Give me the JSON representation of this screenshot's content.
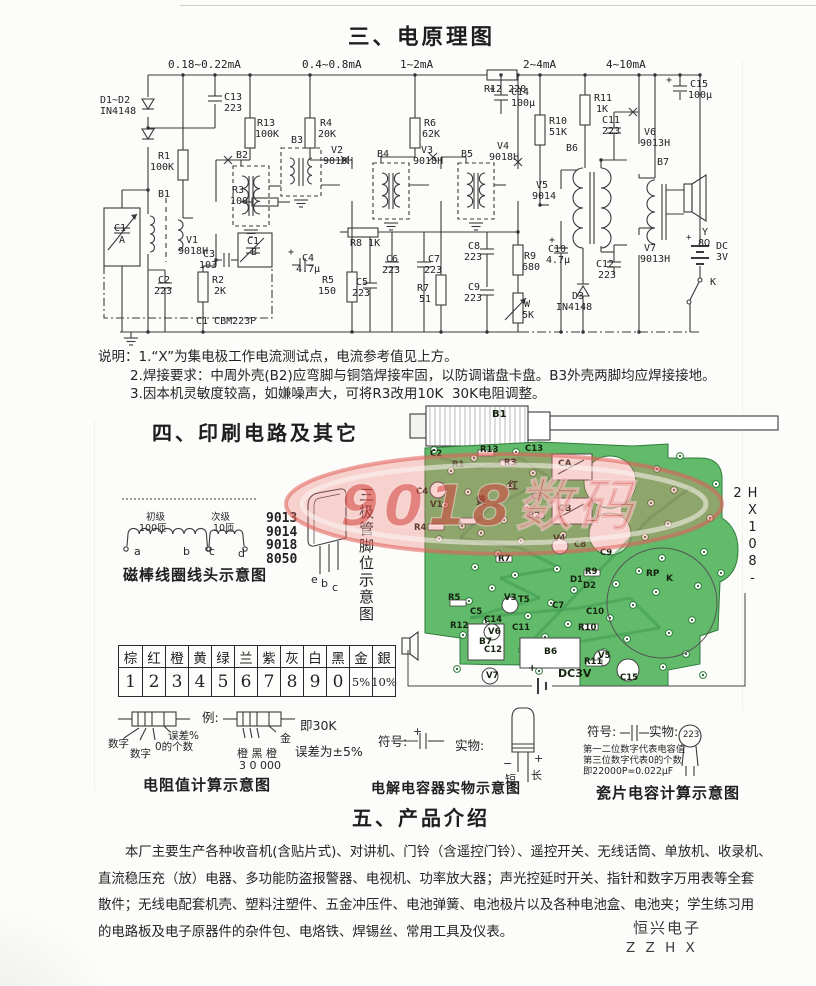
{
  "doc": {
    "section3_title": "三、电原理图",
    "section4_title": "四、印刷电路及其它",
    "section5_title": "五、产品介绍",
    "notes": [
      "说明：1.“X”为集电极工作电流测试点，电流参考值见上方。",
      "2.焊接要求：中周外壳(B2)应弯脚与铜箔焊接牢固，以防调谐盘卡盘。B3外壳两脚均应焊接接地。",
      "3.因本机灵敏度较高，如嫌噪声大，可将R3改用10K  30K电阻调整。"
    ],
    "intro_lines": [
      "本厂主要生产各种收音机(含贴片式)、对讲机、门铃（含遥控门铃）、遥控开关、无线话筒、单放机、收录机、",
      "直流稳压充（放）电器、多功能防盗报警器、电视机、功率放大器；声光控延时开关、指针和数字万用表等全套",
      "散件；无线电配套机壳、塑料注塑件、五金冲压件、电池弹簧、电池极片以及各种电池盒、电池夹；学生练习用",
      "的电路板及电子原器件的杂件包、电烙铁、焊锡丝、常用工具及仪表。"
    ],
    "footer_company": "恒兴电子",
    "footer_code": "Z Z H X"
  },
  "captions": {
    "coil": "磁棒线圈线头示意图",
    "resistor": "电阻值计算示意图",
    "ecap": "电解电容器实物示意图",
    "ceramic": "瓷片电容计算示意图"
  },
  "transistor": {
    "models": [
      "9013",
      "9014",
      "9018",
      "8050"
    ],
    "pins": [
      "e",
      "b",
      "c"
    ],
    "caption": "三极管脚位示意图"
  },
  "color_table": {
    "names": [
      "棕",
      "红",
      "橙",
      "黄",
      "绿",
      "兰",
      "紫",
      "灰",
      "白",
      "黑",
      "金",
      "銀"
    ],
    "values": [
      "1",
      "2",
      "3",
      "4",
      "5",
      "6",
      "7",
      "8",
      "9",
      "0",
      "5%",
      "10%"
    ]
  },
  "watermark": {
    "text": "9018数码"
  },
  "pcb": {
    "board_code": "HX108-2",
    "labels": [
      {
        "t": "B1",
        "x": 92,
        "y": 12,
        "fs": 10
      },
      {
        "t": "C2",
        "x": 30,
        "y": 52
      },
      {
        "t": "R1",
        "x": 52,
        "y": 63
      },
      {
        "t": "R13",
        "x": 80,
        "y": 48
      },
      {
        "t": "R3",
        "x": 104,
        "y": 61
      },
      {
        "t": "C13",
        "x": 125,
        "y": 47
      },
      {
        "t": "CA",
        "x": 158,
        "y": 62,
        "fs": 9
      },
      {
        "t": "CB",
        "x": 158,
        "y": 107,
        "fs": 9
      },
      {
        "t": "C3",
        "x": 131,
        "y": 95
      },
      {
        "t": "黄",
        "x": 76,
        "y": 99,
        "fs": 10
      },
      {
        "t": "红",
        "x": 108,
        "y": 84,
        "fs": 10
      },
      {
        "t": "R2",
        "x": 128,
        "y": 114
      },
      {
        "t": "C4",
        "x": 16,
        "y": 90
      },
      {
        "t": "V1",
        "x": 30,
        "y": 103
      },
      {
        "t": "R4",
        "x": 14,
        "y": 126
      },
      {
        "t": "R7",
        "x": 98,
        "y": 157
      },
      {
        "t": "V4",
        "x": 153,
        "y": 137
      },
      {
        "t": "C8",
        "x": 174,
        "y": 143
      },
      {
        "t": "C9",
        "x": 200,
        "y": 151
      },
      {
        "t": "R5",
        "x": 48,
        "y": 196
      },
      {
        "t": "C5",
        "x": 70,
        "y": 210
      },
      {
        "t": "C14",
        "x": 84,
        "y": 218
      },
      {
        "t": "V3",
        "x": 104,
        "y": 196
      },
      {
        "t": "T5",
        "x": 118,
        "y": 198
      },
      {
        "t": "C7",
        "x": 152,
        "y": 204
      },
      {
        "t": "C10",
        "x": 186,
        "y": 210
      },
      {
        "t": "D1",
        "x": 170,
        "y": 178
      },
      {
        "t": "D2",
        "x": 183,
        "y": 184
      },
      {
        "t": "R9",
        "x": 185,
        "y": 170
      },
      {
        "t": "R12",
        "x": 50,
        "y": 224
      },
      {
        "t": "V6",
        "x": 88,
        "y": 230
      },
      {
        "t": "C11",
        "x": 112,
        "y": 226
      },
      {
        "t": "R10",
        "x": 178,
        "y": 226
      },
      {
        "t": "B6",
        "x": 144,
        "y": 250,
        "fs": 9
      },
      {
        "t": "B7",
        "x": 79,
        "y": 240,
        "fs": 9
      },
      {
        "t": "R11",
        "x": 184,
        "y": 260
      },
      {
        "t": "V5",
        "x": 198,
        "y": 254
      },
      {
        "t": "V7",
        "x": 86,
        "y": 274
      },
      {
        "t": "C12",
        "x": 84,
        "y": 248
      },
      {
        "t": "C15",
        "x": 220,
        "y": 276
      },
      {
        "t": "RP",
        "x": 246,
        "y": 172,
        "fs": 9
      },
      {
        "t": "K",
        "x": 266,
        "y": 177,
        "fs": 9
      },
      {
        "t": "DC3V",
        "x": 158,
        "y": 270,
        "fs": 11
      },
      {
        "t": "+",
        "x": 128,
        "y": 266,
        "fs": 10
      }
    ]
  },
  "annotations": [
    {
      "t": "初级",
      "x": 146,
      "y": 513,
      "fs": 9.5
    },
    {
      "t": "100匝",
      "x": 139,
      "y": 524,
      "fs": 9.5
    },
    {
      "t": "次级",
      "x": 211,
      "y": 513,
      "fs": 9.5
    },
    {
      "t": "10匝",
      "x": 213,
      "y": 524,
      "fs": 9.5
    },
    {
      "t": "a",
      "x": 134,
      "y": 546,
      "fs": 11
    },
    {
      "t": "b",
      "x": 183,
      "y": 546,
      "fs": 11
    },
    {
      "t": "c",
      "x": 209,
      "y": 546,
      "fs": 11
    },
    {
      "t": "d",
      "x": 238,
      "y": 548,
      "fs": 11
    },
    {
      "t": "数字",
      "x": 108,
      "y": 739,
      "fs": 10.5
    },
    {
      "t": "数字",
      "x": 130,
      "y": 749,
      "fs": 10.5
    },
    {
      "t": "0的个数",
      "x": 155,
      "y": 742,
      "fs": 10.5
    },
    {
      "t": "误差%",
      "x": 168,
      "y": 731,
      "fs": 10.5
    },
    {
      "t": "例:",
      "x": 202,
      "y": 712,
      "fs": 12.5
    },
    {
      "t": "金",
      "x": 280,
      "y": 733,
      "fs": 11
    },
    {
      "t": "橙 黑 橙",
      "x": 237,
      "y": 748,
      "fs": 11
    },
    {
      "t": "3 0 000",
      "x": 239,
      "y": 760,
      "fs": 11
    },
    {
      "t": "即30K",
      "x": 300,
      "y": 720,
      "fs": 12.5
    },
    {
      "t": "误差为±5%",
      "x": 295,
      "y": 746,
      "fs": 12.5
    },
    {
      "t": "符号:",
      "x": 378,
      "y": 736,
      "fs": 12.5
    },
    {
      "t": "+",
      "x": 413,
      "y": 726,
      "fs": 11
    },
    {
      "t": "实物:",
      "x": 455,
      "y": 740,
      "fs": 12.5
    },
    {
      "t": "−",
      "x": 503,
      "y": 758,
      "fs": 11
    },
    {
      "t": "+",
      "x": 534,
      "y": 753,
      "fs": 11
    },
    {
      "t": "短",
      "x": 505,
      "y": 774,
      "fs": 11
    },
    {
      "t": "长",
      "x": 531,
      "y": 770,
      "fs": 11
    },
    {
      "t": "符号:",
      "x": 587,
      "y": 726,
      "fs": 12.5
    },
    {
      "t": "实物:",
      "x": 649,
      "y": 726,
      "fs": 12.5
    },
    {
      "t": "223",
      "x": 683,
      "y": 731,
      "fs": 8.5
    },
    {
      "t": "第一二位数字代表电容值",
      "x": 583,
      "y": 745,
      "fs": 9.3
    },
    {
      "t": "第三位数字代表0的个数",
      "x": 583,
      "y": 756,
      "fs": 9.3
    },
    {
      "t": "即22000P=0.022μF",
      "x": 583,
      "y": 767,
      "fs": 9.3
    }
  ],
  "schematic": {
    "labels": [
      {
        "t": "0.18~0.22mA",
        "x": 168,
        "y": 59,
        "fs": 11
      },
      {
        "t": "0.4~0.8mA",
        "x": 302,
        "y": 59,
        "fs": 11
      },
      {
        "t": "1~2mA",
        "x": 400,
        "y": 59,
        "fs": 11
      },
      {
        "t": "2~4mA",
        "x": 523,
        "y": 59,
        "fs": 11
      },
      {
        "t": "4~10mA",
        "x": 606,
        "y": 59,
        "fs": 11
      },
      {
        "t": "R12 220",
        "x": 484,
        "y": 85
      },
      {
        "t": "D1~D2",
        "x": 100,
        "y": 96
      },
      {
        "t": "IN4148",
        "x": 100,
        "y": 107
      },
      {
        "t": "C13",
        "x": 224,
        "y": 93
      },
      {
        "t": "223",
        "x": 224,
        "y": 104
      },
      {
        "t": "R13",
        "x": 257,
        "y": 119
      },
      {
        "t": "100K",
        "x": 255,
        "y": 130
      },
      {
        "t": "R1",
        "x": 158,
        "y": 152
      },
      {
        "t": "100K",
        "x": 150,
        "y": 163
      },
      {
        "t": "R4",
        "x": 320,
        "y": 119
      },
      {
        "t": "20K",
        "x": 318,
        "y": 130
      },
      {
        "t": "R6",
        "x": 424,
        "y": 119
      },
      {
        "t": "62K",
        "x": 422,
        "y": 130
      },
      {
        "t": "C14",
        "x": 511,
        "y": 88
      },
      {
        "t": "100μ",
        "x": 511,
        "y": 99
      },
      {
        "t": "+",
        "x": 489,
        "y": 85
      },
      {
        "t": "R10",
        "x": 549,
        "y": 117
      },
      {
        "t": "51K",
        "x": 549,
        "y": 128
      },
      {
        "t": "R11",
        "x": 594,
        "y": 94
      },
      {
        "t": "1K",
        "x": 596,
        "y": 105
      },
      {
        "t": "C11",
        "x": 602,
        "y": 116
      },
      {
        "t": "223",
        "x": 602,
        "y": 127
      },
      {
        "t": "C15",
        "x": 690,
        "y": 80
      },
      {
        "t": "100μ",
        "x": 688,
        "y": 91
      },
      {
        "t": "+",
        "x": 666,
        "y": 76
      },
      {
        "t": "V6",
        "x": 644,
        "y": 128
      },
      {
        "t": "9013H",
        "x": 640,
        "y": 139
      },
      {
        "t": "B2",
        "x": 236,
        "y": 151
      },
      {
        "t": "B3",
        "x": 291,
        "y": 136
      },
      {
        "t": "B4",
        "x": 377,
        "y": 150
      },
      {
        "t": "B5",
        "x": 461,
        "y": 150
      },
      {
        "t": "B6",
        "x": 566,
        "y": 144
      },
      {
        "t": "B7",
        "x": 657,
        "y": 158
      },
      {
        "t": "V2",
        "x": 331,
        "y": 146
      },
      {
        "t": "9018H",
        "x": 323,
        "y": 157
      },
      {
        "t": "V3",
        "x": 421,
        "y": 146
      },
      {
        "t": "9018H",
        "x": 413,
        "y": 157
      },
      {
        "t": "V4",
        "x": 497,
        "y": 142
      },
      {
        "t": "9018H",
        "x": 489,
        "y": 153
      },
      {
        "t": "V5",
        "x": 536,
        "y": 181
      },
      {
        "t": "9014",
        "x": 532,
        "y": 192
      },
      {
        "t": "B1",
        "x": 158,
        "y": 190
      },
      {
        "t": "V1",
        "x": 186,
        "y": 236
      },
      {
        "t": "9018H",
        "x": 178,
        "y": 247
      },
      {
        "t": "C1",
        "x": 114,
        "y": 224
      },
      {
        "t": "A",
        "x": 119,
        "y": 236
      },
      {
        "t": "C1",
        "x": 247,
        "y": 237
      },
      {
        "t": "B",
        "x": 251,
        "y": 248
      },
      {
        "t": "C3",
        "x": 203,
        "y": 250
      },
      {
        "t": "103",
        "x": 199,
        "y": 261
      },
      {
        "t": "R3",
        "x": 232,
        "y": 186
      },
      {
        "t": "100",
        "x": 230,
        "y": 197
      },
      {
        "t": "C2",
        "x": 158,
        "y": 276
      },
      {
        "t": "223",
        "x": 154,
        "y": 287
      },
      {
        "t": "R2",
        "x": 212,
        "y": 276
      },
      {
        "t": "2K",
        "x": 214,
        "y": 287
      },
      {
        "t": "C4",
        "x": 302,
        "y": 254
      },
      {
        "t": "4.7μ",
        "x": 296,
        "y": 265
      },
      {
        "t": "+",
        "x": 288,
        "y": 248
      },
      {
        "t": "R5",
        "x": 322,
        "y": 276
      },
      {
        "t": "150",
        "x": 318,
        "y": 287
      },
      {
        "t": "R8 1K",
        "x": 350,
        "y": 239
      },
      {
        "t": "C5",
        "x": 356,
        "y": 278
      },
      {
        "t": "223",
        "x": 352,
        "y": 289
      },
      {
        "t": "C6",
        "x": 386,
        "y": 255
      },
      {
        "t": "223",
        "x": 382,
        "y": 266
      },
      {
        "t": "R7",
        "x": 417,
        "y": 284
      },
      {
        "t": "51",
        "x": 419,
        "y": 295
      },
      {
        "t": "C7",
        "x": 428,
        "y": 255
      },
      {
        "t": "223",
        "x": 424,
        "y": 266
      },
      {
        "t": "C8",
        "x": 468,
        "y": 242
      },
      {
        "t": "223",
        "x": 464,
        "y": 253
      },
      {
        "t": "R9",
        "x": 524,
        "y": 252
      },
      {
        "t": "680",
        "x": 522,
        "y": 263
      },
      {
        "t": "C9",
        "x": 468,
        "y": 283
      },
      {
        "t": "223",
        "x": 464,
        "y": 294
      },
      {
        "t": "W",
        "x": 524,
        "y": 300
      },
      {
        "t": "5K",
        "x": 522,
        "y": 311
      },
      {
        "t": "C10",
        "x": 548,
        "y": 245
      },
      {
        "t": "4.7μ",
        "x": 546,
        "y": 256
      },
      {
        "t": "+",
        "x": 549,
        "y": 236
      },
      {
        "t": "D3",
        "x": 572,
        "y": 292
      },
      {
        "t": "IN4148",
        "x": 556,
        "y": 303
      },
      {
        "t": "C12",
        "x": 596,
        "y": 260
      },
      {
        "t": "223",
        "x": 598,
        "y": 271
      },
      {
        "t": "V7",
        "x": 644,
        "y": 244
      },
      {
        "t": "9013H",
        "x": 640,
        "y": 255
      },
      {
        "t": "Y",
        "x": 702,
        "y": 228
      },
      {
        "t": "8Ω",
        "x": 698,
        "y": 239
      },
      {
        "t": "DC",
        "x": 716,
        "y": 242
      },
      {
        "t": "3V",
        "x": 716,
        "y": 253
      },
      {
        "t": "+",
        "x": 686,
        "y": 234,
        "fs": 9
      },
      {
        "t": "K",
        "x": 710,
        "y": 278
      },
      {
        "t": "C1 CBM223P",
        "x": 196,
        "y": 317
      }
    ]
  }
}
